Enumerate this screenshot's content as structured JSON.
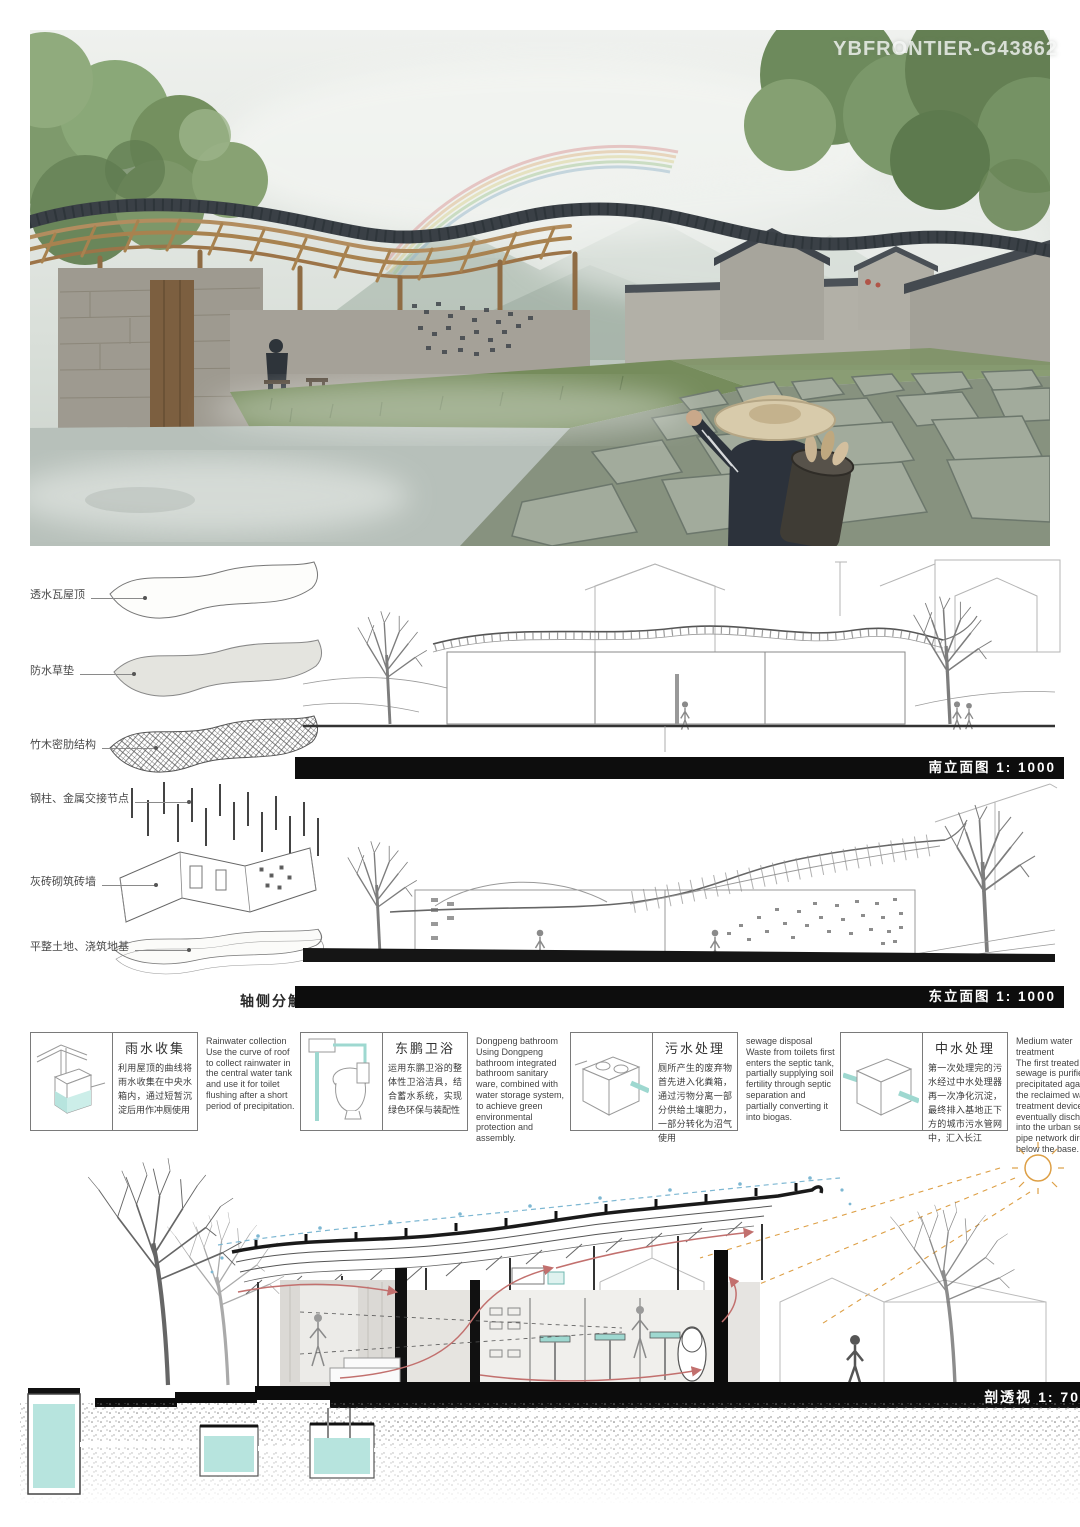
{
  "watermark": "YBFRONTIER-G43862",
  "axon": {
    "caption": "轴侧分解图",
    "labels": [
      {
        "text": "透水瓦屋顶"
      },
      {
        "text": "防水草垫"
      },
      {
        "text": "竹木密肋结构"
      },
      {
        "text": "钢柱、金属交接节点"
      },
      {
        "text": "灰砖砌筑砖墙"
      },
      {
        "text": "平整土地、浇筑地基"
      }
    ]
  },
  "elevations": {
    "south_title": "南立面图 1: 1000",
    "east_title": "东立面图 1: 1000"
  },
  "info_boxes": [
    {
      "title": "雨水收集",
      "zh": "利用屋顶的曲线将雨水收集在中央水箱内，通过短暂沉淀后用作冲厕使用",
      "en": "Rainwater collection\nUse the curve of roof to collect rainwater in the central water tank and use it for toilet flushing after a short period of precipitation.",
      "icon": "rainwater-tank-diagram"
    },
    {
      "title": "东鹏卫浴",
      "zh": "运用东鹏卫浴的整体性卫浴洁具，结合蓄水系统，实现绿色环保与装配性",
      "en": "Dongpeng bathroom\nUsing Dongpeng bathroom integrated bathroom sanitary ware, combined with water storage system, to achieve green environmental protection and assembly.",
      "icon": "toilet-diagram"
    },
    {
      "title": "污水处理",
      "zh": "厕所产生的废弃物首先进入化粪箱，通过污物分离一部分供给土壤肥力，一部分转化为沼气使用",
      "en": "sewage disposal\nWaste from toilets first enters the septic tank, partially supplying soil fertility through septic separation and partially converting it into biogas.",
      "icon": "septic-tank-diagram"
    },
    {
      "title": "中水处理",
      "zh": "第一次处理完的污水经过中水处理器再一次净化沉淀，最终排入基地正下方的城市污水管网中，汇入长江",
      "en": "Medium water treatment\nThe first treated sewage is purified and precipitated again by the reclaimed water treatment device, and eventually discharged into the urban sewage pipe network directly below the base.",
      "icon": "water-treatment-cube-diagram"
    }
  ],
  "section": {
    "title": "剖透视 1: 70"
  },
  "colors": {
    "accent_teal": "#b7e4de",
    "arrow_red": "#c2706e",
    "rain_blue": "#7db7d2",
    "sun_orange": "#dd9f45",
    "bar_black": "#0d0d0d"
  }
}
